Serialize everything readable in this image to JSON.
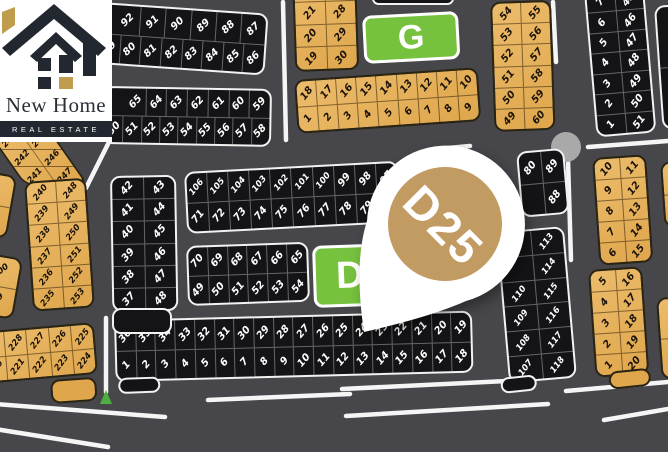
{
  "logo": {
    "brand": "New Home",
    "tagline": "REAL ESTATE"
  },
  "pin": {
    "label": "D25"
  },
  "zone_labels": {
    "g": "G",
    "d": "D"
  },
  "colors": {
    "road_bg": "#47474b",
    "plot_dark": "#141417",
    "plot_gold": "#dfa64c",
    "plot_gold_light": "#ecbc6b",
    "zone_green": "#76c13d",
    "pin_gold": "#c29b62",
    "roundabout_gray": "#a9a9a9",
    "marker_green": "#4caf3f",
    "road_line": "#f5f5f5",
    "logo_gold": "#c09c4f",
    "logo_dark": "#232830"
  },
  "plot_blocks": {
    "top_left_a": {
      "rows": [
        [
          "92",
          "91",
          "90",
          "89",
          "88",
          "87"
        ],
        [
          "79",
          "80",
          "81",
          "82",
          "83",
          "84",
          "85",
          "86"
        ]
      ]
    },
    "top_left_b": {
      "rows": [
        [
          "65",
          "64",
          "63",
          "62",
          "61",
          "60",
          "59"
        ],
        [
          "50",
          "51",
          "52",
          "53",
          "54",
          "55",
          "56",
          "57",
          "58"
        ]
      ]
    },
    "top_gold_c": {
      "rows": [
        [
          "",
          ""
        ],
        [
          "21",
          "28"
        ],
        [
          "20",
          "29"
        ],
        [
          "19",
          "30"
        ]
      ]
    },
    "mid_gold_e": {
      "rows": [
        [
          "18",
          "17",
          "16",
          "15",
          "14",
          "13",
          "12",
          "11",
          "10"
        ],
        [
          "1",
          "2",
          "3",
          "4",
          "5",
          "6",
          "7",
          "8",
          "9"
        ]
      ]
    },
    "gold_f": {
      "rows": [
        [
          "54",
          "55"
        ],
        [
          "53",
          "56"
        ],
        [
          "52",
          "57"
        ],
        [
          "51",
          "58"
        ],
        [
          "50",
          "59"
        ],
        [
          "49",
          "60"
        ]
      ]
    },
    "tr_black_h": {
      "rows": [
        [
          "7",
          "45"
        ],
        [
          "6",
          "46"
        ],
        [
          "5",
          "47"
        ],
        [
          "4",
          "48"
        ],
        [
          "3",
          "49"
        ],
        [
          "2",
          "50"
        ],
        [
          "1",
          "51"
        ]
      ]
    },
    "left_curve_top": {
      "rows": [
        [
          "243",
          "245"
        ],
        [
          "242",
          "246"
        ],
        [
          "241",
          "247"
        ]
      ]
    },
    "left_curve_bottom": {
      "rows": [
        [
          "240",
          "248"
        ],
        [
          "239",
          "249"
        ],
        [
          "238",
          "250"
        ],
        [
          "237",
          "251"
        ],
        [
          "236",
          "252"
        ],
        [
          "235",
          "253"
        ]
      ]
    },
    "left_edge_strip": {
      "rows": [
        [
          ""
        ],
        [
          ""
        ]
      ]
    },
    "left_200": {
      "rows": [
        [
          "200"
        ],
        [
          "199"
        ]
      ]
    },
    "black_3748": {
      "rows": [
        [
          "42",
          "43"
        ],
        [
          "41",
          "44"
        ],
        [
          "40",
          "45"
        ],
        [
          "39",
          "46"
        ],
        [
          "38",
          "47"
        ],
        [
          "37",
          "48"
        ]
      ]
    },
    "long_71_106": {
      "rows": [
        [
          "106",
          "105",
          "104",
          "103",
          "102",
          "101",
          "100",
          "99",
          "98",
          "97"
        ],
        [
          "71",
          "72",
          "73",
          "74",
          "75",
          "76",
          "77",
          "78",
          "79",
          ""
        ]
      ]
    },
    "black_49_70": {
      "rows": [
        [
          "70",
          "69",
          "68",
          "67",
          "66",
          "65"
        ],
        [
          "49",
          "50",
          "51",
          "52",
          "53",
          "54"
        ]
      ]
    },
    "long_bottom_d": {
      "rows": [
        [
          "36",
          "35",
          "34",
          "33",
          "32",
          "31",
          "30",
          "29",
          "28",
          "27",
          "26",
          "25",
          "24",
          "23",
          "22",
          "21",
          "20",
          "19"
        ],
        [
          "1",
          "2",
          "3",
          "4",
          "5",
          "6",
          "7",
          "8",
          "9",
          "10",
          "11",
          "12",
          "13",
          "14",
          "15",
          "16",
          "17",
          "18"
        ]
      ]
    },
    "br_black_107": {
      "rows": [
        [
          "",
          "113"
        ],
        [
          "",
          "114"
        ],
        [
          "110",
          "115"
        ],
        [
          "109",
          "116"
        ],
        [
          "108",
          "117"
        ],
        [
          "107",
          "118"
        ]
      ]
    },
    "mini_black_88": {
      "rows": [
        [
          "80",
          "89"
        ],
        [
          "",
          "88"
        ]
      ]
    },
    "gold_p1": {
      "rows": [
        [
          "10",
          "11"
        ],
        [
          "9",
          "12"
        ],
        [
          "8",
          "13"
        ],
        [
          "7",
          "14"
        ],
        [
          "6",
          "15"
        ]
      ]
    },
    "gold_p2": {
      "rows": [
        [
          "5",
          "16"
        ],
        [
          "4",
          "17"
        ],
        [
          "3",
          "18"
        ],
        [
          "2",
          "19"
        ],
        [
          "1",
          "20"
        ]
      ]
    },
    "bl_gold_220": {
      "rows": [
        [
          "229",
          "228",
          "227",
          "226",
          "225"
        ],
        [
          "220",
          "221",
          "222",
          "223",
          "224"
        ]
      ]
    },
    "top_sliver": {
      "rows": [
        [
          ""
        ]
      ]
    },
    "fr_black": {
      "rows": [
        [
          "",
          ""
        ],
        [
          "",
          ""
        ]
      ]
    },
    "fr_gold_1": {
      "rows": [
        [
          ""
        ],
        [
          ""
        ]
      ]
    },
    "fr_gold_2": {
      "rows": [
        [
          ""
        ],
        [
          ""
        ]
      ]
    }
  }
}
